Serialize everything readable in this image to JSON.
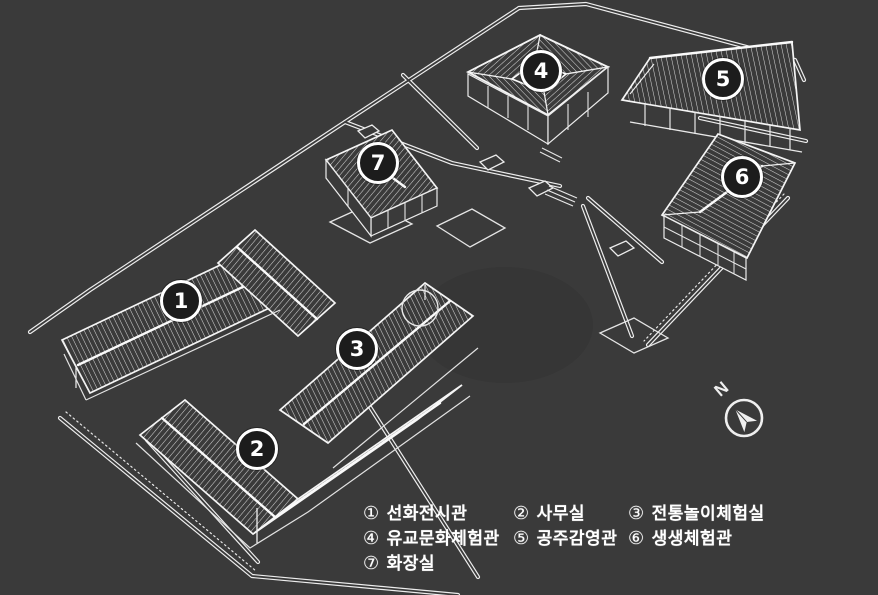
{
  "colors": {
    "background": "#3a3a3a",
    "line": "#f0f0f0",
    "hatch": "#d6d6d6",
    "badge_fill": "#1c1c1c",
    "badge_border": "#ffffff",
    "text": "#ffffff"
  },
  "compass": {
    "letter": "N"
  },
  "buildings": [
    {
      "num": "1",
      "symbol": "①",
      "label": "선화전시관"
    },
    {
      "num": "2",
      "symbol": "②",
      "label": "사무실"
    },
    {
      "num": "3",
      "symbol": "③",
      "label": "전통놀이체험실"
    },
    {
      "num": "4",
      "symbol": "④",
      "label": "유교문화체험관"
    },
    {
      "num": "5",
      "symbol": "⑤",
      "label": "공주감영관"
    },
    {
      "num": "6",
      "symbol": "⑥",
      "label": "생생체험관"
    },
    {
      "num": "7",
      "symbol": "⑦",
      "label": "화장실"
    }
  ]
}
